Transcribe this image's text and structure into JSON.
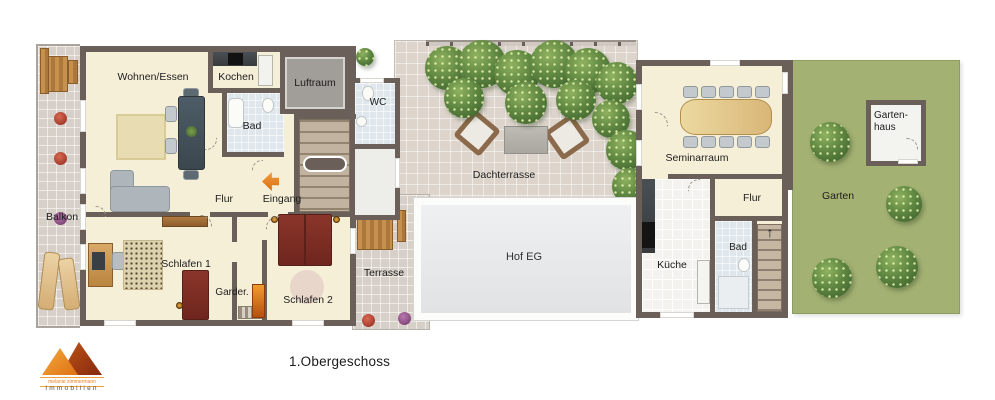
{
  "title": "1.Obergeschoss",
  "logo": {
    "company": "melanie zimmermann",
    "tagline": "Immobilien"
  },
  "labels": {
    "balkon": "Balkon",
    "wohnen_essen": "Wohnen/Essen",
    "kochen": "Kochen",
    "luftraum": "Luftraum",
    "wc": "WC",
    "bad_left": "Bad",
    "flur_left": "Flur",
    "eingang": "Eingang",
    "schlafen1": "Schlafen 1",
    "garderobe": "Garder.",
    "schlafen2": "Schlafen 2",
    "terrasse": "Terrasse",
    "dachterrasse": "Dachterrasse",
    "hof_eg": "Hof EG",
    "seminarraum": "Seminarraum",
    "kueche": "Küche",
    "flur_right": "Flur",
    "bad_right": "Bad",
    "garten": "Garten",
    "gartenhaus_line1": "Garten-",
    "gartenhaus_line2": "haus"
  },
  "icons": {
    "stairs_up": "↑"
  },
  "colors": {
    "wall": "#6b5f59",
    "floor_cream": "#f6efd8",
    "tile_terrace": "#d7d0c8",
    "tile_roof": "#ddd5cc",
    "bath_blue": "#dfe7ec",
    "void_gray": "#a19d98",
    "courtyard_gray": "#e8eaec",
    "garden_green": "#a3b173",
    "accent_orange": "#e8821e",
    "bed_red": "#7c2d24",
    "wood_brown": "#c08a4e",
    "table_wood_light": "#e2c184"
  }
}
